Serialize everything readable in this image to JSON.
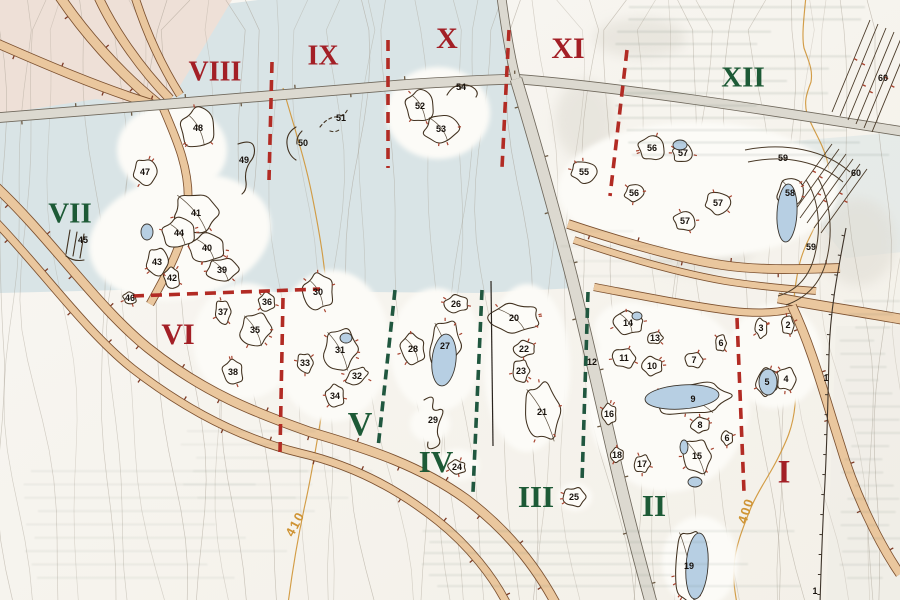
{
  "map": {
    "colors": {
      "paper": "#f8f6f1",
      "valley": "#d9e4e6",
      "pink": "#eee0d7",
      "white_area": "#fcfbf7",
      "zone_red": "#a31f26",
      "zone_green": "#1d5a36",
      "boundary_red": "#b22b24",
      "boundary_green": "#20573f",
      "water": "#b7cfe3",
      "water_edge": "#3a342c",
      "road_fill": "#eac79e",
      "road_casing": "#7c5130",
      "gray_road_fill": "#dcd9d0",
      "gray_road_casing": "#6f685c",
      "contour": "#a1988a",
      "contour_index": "#cf9434",
      "ink": "#41311f",
      "tick_red": "#a84430",
      "label_ink": "#17110c"
    },
    "zones": [
      {
        "label": "VIII",
        "x": 215,
        "y": 74,
        "c": "red",
        "s": 28
      },
      {
        "label": "IX",
        "x": 323,
        "y": 58,
        "c": "red",
        "s": 28
      },
      {
        "label": "X",
        "x": 447,
        "y": 41,
        "c": "red",
        "s": 30
      },
      {
        "label": "XI",
        "x": 568,
        "y": 51,
        "c": "red",
        "s": 30
      },
      {
        "label": "XII",
        "x": 743,
        "y": 80,
        "c": "green",
        "s": 29
      },
      {
        "label": "VII",
        "x": 70,
        "y": 216,
        "c": "green",
        "s": 29
      },
      {
        "label": "VI",
        "x": 178,
        "y": 337,
        "c": "red",
        "s": 30
      },
      {
        "label": "V",
        "x": 360,
        "y": 427,
        "c": "green",
        "s": 34
      },
      {
        "label": "IV",
        "x": 436,
        "y": 465,
        "c": "green",
        "s": 31
      },
      {
        "label": "III",
        "x": 536,
        "y": 500,
        "c": "green",
        "s": 31
      },
      {
        "label": "II",
        "x": 654,
        "y": 509,
        "c": "green",
        "s": 31
      },
      {
        "label": "I",
        "x": 784,
        "y": 475,
        "c": "red",
        "s": 33
      }
    ],
    "contour_labels": [
      {
        "text": "410",
        "x": 299,
        "y": 526,
        "rot": -62
      },
      {
        "text": "400",
        "x": 750,
        "y": 512,
        "rot": -72
      }
    ],
    "features": [
      {
        "n": "1",
        "x": 826,
        "y": 378,
        "t": "none"
      },
      {
        "n": "1",
        "x": 815,
        "y": 591,
        "t": "none"
      },
      {
        "n": "2",
        "x": 788,
        "y": 325,
        "rx": 7,
        "ry": 9
      },
      {
        "n": "3",
        "x": 761,
        "y": 328,
        "rx": 6,
        "ry": 10
      },
      {
        "n": "4",
        "x": 786,
        "y": 379,
        "rx": 10,
        "ry": 12
      },
      {
        "n": "5",
        "x": 767,
        "y": 382,
        "rx": 11,
        "ry": 14
      },
      {
        "n": "6",
        "x": 721,
        "y": 343,
        "rx": 6,
        "ry": 8
      },
      {
        "n": "6",
        "x": 727,
        "y": 438,
        "rx": 6,
        "ry": 7
      },
      {
        "n": "7",
        "x": 694,
        "y": 360,
        "rx": 9,
        "ry": 8
      },
      {
        "n": "8",
        "x": 700,
        "y": 425,
        "rx": 9,
        "ry": 8
      },
      {
        "n": "9",
        "x": 693,
        "y": 399,
        "rx": 40,
        "ry": 15,
        "rot": -5
      },
      {
        "n": "10",
        "x": 652,
        "y": 366,
        "rx": 11,
        "ry": 9
      },
      {
        "n": "11",
        "x": 624,
        "y": 358,
        "rx": 12,
        "ry": 10
      },
      {
        "n": "12",
        "x": 592,
        "y": 362,
        "t": "none"
      },
      {
        "n": "13",
        "x": 655,
        "y": 338,
        "rx": 8,
        "ry": 6
      },
      {
        "n": "14",
        "x": 628,
        "y": 323,
        "rx": 16,
        "ry": 11,
        "rot": 10
      },
      {
        "n": "15",
        "x": 697,
        "y": 456,
        "rx": 15,
        "ry": 17
      },
      {
        "n": "16",
        "x": 609,
        "y": 414,
        "rx": 7,
        "ry": 11
      },
      {
        "n": "17",
        "x": 642,
        "y": 464,
        "rx": 8,
        "ry": 9
      },
      {
        "n": "18",
        "x": 617,
        "y": 455,
        "rx": 7,
        "ry": 7
      },
      {
        "n": "19",
        "x": 689,
        "y": 566,
        "rx": 15,
        "ry": 36,
        "rot": 4
      },
      {
        "n": "20",
        "x": 514,
        "y": 318,
        "rx": 25,
        "ry": 15,
        "rot": -5
      },
      {
        "n": "21",
        "x": 542,
        "y": 412,
        "rx": 17,
        "ry": 30,
        "rot": -8
      },
      {
        "n": "22",
        "x": 524,
        "y": 349,
        "rx": 11,
        "ry": 8
      },
      {
        "n": "23",
        "x": 521,
        "y": 371,
        "rx": 9,
        "ry": 11
      },
      {
        "n": "24",
        "x": 457,
        "y": 467,
        "rx": 9,
        "ry": 7
      },
      {
        "n": "25",
        "x": 574,
        "y": 497,
        "rx": 11,
        "ry": 10
      },
      {
        "n": "26",
        "x": 456,
        "y": 304,
        "rx": 12,
        "ry": 9
      },
      {
        "n": "27",
        "x": 445,
        "y": 346,
        "rx": 16,
        "ry": 25,
        "rot": 5
      },
      {
        "n": "28",
        "x": 413,
        "y": 349,
        "rx": 13,
        "ry": 15
      },
      {
        "n": "29",
        "x": 433,
        "y": 420,
        "t": "line",
        "d": "M424,400 q11,-7 9,3 q-2,9 5,7 q8,-3 3,8 q-6,13 -2,20 q3,7 -5,10 q-8,3 -6,-6"
      },
      {
        "n": "30",
        "x": 318,
        "y": 292,
        "rx": 15,
        "ry": 19
      },
      {
        "n": "31",
        "x": 340,
        "y": 350,
        "rx": 17,
        "ry": 21
      },
      {
        "n": "32",
        "x": 357,
        "y": 376,
        "rx": 13,
        "ry": 7,
        "rot": -35
      },
      {
        "n": "33",
        "x": 305,
        "y": 363,
        "rx": 8,
        "ry": 10
      },
      {
        "n": "34",
        "x": 335,
        "y": 396,
        "rx": 9,
        "ry": 12
      },
      {
        "n": "35",
        "x": 255,
        "y": 330,
        "rx": 15,
        "ry": 17
      },
      {
        "n": "36",
        "x": 267,
        "y": 302,
        "rx": 9,
        "ry": 9
      },
      {
        "n": "37",
        "x": 223,
        "y": 312,
        "rx": 8,
        "ry": 12
      },
      {
        "n": "38",
        "x": 233,
        "y": 372,
        "rx": 10,
        "ry": 13
      },
      {
        "n": "39",
        "x": 222,
        "y": 270,
        "rx": 15,
        "ry": 12
      },
      {
        "n": "40",
        "x": 207,
        "y": 248,
        "rx": 19,
        "ry": 14
      },
      {
        "n": "41",
        "x": 196,
        "y": 213,
        "rx": 23,
        "ry": 19
      },
      {
        "n": "42",
        "x": 172,
        "y": 278,
        "rx": 8,
        "ry": 11
      },
      {
        "n": "43",
        "x": 157,
        "y": 262,
        "rx": 10,
        "ry": 15
      },
      {
        "n": "44",
        "x": 179,
        "y": 233,
        "rx": 17,
        "ry": 15
      },
      {
        "n": "45",
        "x": 83,
        "y": 240,
        "t": "line",
        "d": "M70,230 l-4,24 M77,232 l-4,24 M84,234 l-4,24 M66,256 q8,6 18,4"
      },
      {
        "n": "46",
        "x": 130,
        "y": 298,
        "rx": 7,
        "ry": 6
      },
      {
        "n": "47",
        "x": 145,
        "y": 172,
        "rx": 11,
        "ry": 14
      },
      {
        "n": "48",
        "x": 198,
        "y": 128,
        "rx": 17,
        "ry": 21
      },
      {
        "n": "49",
        "x": 244,
        "y": 160,
        "t": "line",
        "d": "M238,144 q14,-5 16,3 q2,8 -4,15 q-6,9 -4,20 q1,8 -4,12"
      },
      {
        "n": "50",
        "x": 303,
        "y": 143,
        "t": "line",
        "d": "M296,127 q-10,6 -9,17 q1,11 9,16 M302,131 q-6,6 -5,13"
      },
      {
        "n": "51",
        "x": 341,
        "y": 118,
        "t": "line",
        "dash": true,
        "d": "M320,127 q7,-9 15,-10 q11,-1 13,-9 M330,131 q6,2 10,-2"
      },
      {
        "n": "52",
        "x": 420,
        "y": 106,
        "rx": 14,
        "ry": 17
      },
      {
        "n": "53",
        "x": 441,
        "y": 129,
        "rx": 17,
        "ry": 14
      },
      {
        "n": "54",
        "x": 461,
        "y": 87,
        "t": "line",
        "d": "M447,95 q5,-9 13,-10 q10,-1 15,4 q4,4 1,8"
      },
      {
        "n": "55",
        "x": 584,
        "y": 172,
        "rx": 13,
        "ry": 11
      },
      {
        "n": "56",
        "x": 652,
        "y": 148,
        "rx": 13,
        "ry": 13
      },
      {
        "n": "56",
        "x": 634,
        "y": 193,
        "rx": 9,
        "ry": 9
      },
      {
        "n": "57",
        "x": 683,
        "y": 153,
        "rx": 11,
        "ry": 9
      },
      {
        "n": "57",
        "x": 718,
        "y": 203,
        "rx": 13,
        "ry": 11
      },
      {
        "n": "57",
        "x": 685,
        "y": 221,
        "rx": 11,
        "ry": 10
      },
      {
        "n": "58",
        "x": 790,
        "y": 193,
        "rx": 12,
        "ry": 16
      },
      {
        "n": "59",
        "x": 783,
        "y": 158,
        "t": "none"
      },
      {
        "n": "59",
        "x": 811,
        "y": 247,
        "t": "none"
      },
      {
        "n": "60",
        "x": 883,
        "y": 78,
        "t": "none"
      },
      {
        "n": "60",
        "x": 856,
        "y": 173,
        "t": "none"
      }
    ],
    "ponds": [
      {
        "x": 147,
        "y": 232,
        "rx": 6,
        "ry": 8,
        "rot": 0
      },
      {
        "x": 346,
        "y": 338,
        "rx": 6,
        "ry": 5,
        "rot": 0
      },
      {
        "x": 444,
        "y": 360,
        "rx": 12,
        "ry": 26,
        "rot": 6
      },
      {
        "x": 682,
        "y": 397,
        "rx": 37,
        "ry": 12,
        "rot": -4
      },
      {
        "x": 768,
        "y": 382,
        "rx": 9,
        "ry": 13,
        "rot": 0
      },
      {
        "x": 684,
        "y": 447,
        "rx": 4,
        "ry": 7,
        "rot": 0
      },
      {
        "x": 695,
        "y": 482,
        "rx": 7,
        "ry": 5,
        "rot": 0
      },
      {
        "x": 697,
        "y": 566,
        "rx": 11,
        "ry": 33,
        "rot": 4
      },
      {
        "x": 680,
        "y": 145,
        "rx": 7,
        "ry": 5,
        "rot": 0
      },
      {
        "x": 787,
        "y": 213,
        "rx": 10,
        "ry": 29,
        "rot": 3
      },
      {
        "x": 637,
        "y": 316,
        "rx": 5,
        "ry": 4,
        "rot": 0
      }
    ],
    "terrain": {
      "valley": "M0,46 L92,27 L185,9 L258,0 L500,0 L506,20 L516,79 L553,208 L576,288 L480,293 L360,292 L240,292 L120,290 L0,293 Z",
      "pink": "M0,0 L232,0 L166,109 L96,99 L0,114 Z",
      "blue2": "M793,141 L902,132 L902,252 L846,258 L806,206 Z",
      "graywash": "M836,326 L902,326 L902,606 L826,606 Z"
    },
    "white_areas": [
      [
        172,
        150,
        55,
        46,
        0
      ],
      [
        438,
        113,
        52,
        46,
        0
      ],
      [
        180,
        237,
        92,
        62,
        -12
      ],
      [
        245,
        341,
        52,
        58,
        0
      ],
      [
        332,
        346,
        58,
        76,
        0
      ],
      [
        436,
        350,
        46,
        62,
        0
      ],
      [
        527,
        368,
        43,
        84,
        0
      ],
      [
        668,
        398,
        82,
        94,
        0
      ],
      [
        775,
        356,
        47,
        52,
        0
      ],
      [
        700,
        562,
        38,
        46,
        0
      ],
      [
        698,
        190,
        140,
        68,
        0
      ],
      [
        458,
        465,
        21,
        16,
        0
      ],
      [
        575,
        497,
        17,
        14,
        0
      ],
      [
        430,
        424,
        20,
        18,
        0
      ],
      [
        630,
        330,
        36,
        28,
        0
      ]
    ],
    "roads": {
      "tan": [
        {
          "d": "M58,-6 C82,30 118,72 158,104",
          "w": 9
        },
        {
          "d": "M97,-6 C112,28 140,68 170,99",
          "w": 8
        },
        {
          "d": "M134,-6 C144,26 158,60 180,95",
          "w": 7
        },
        {
          "d": "M-6,42 C42,63 100,88 152,104",
          "w": 8
        },
        {
          "d": "M161,103 C176,138 190,168 188,204 C186,240 168,272 150,304",
          "w": 7
        },
        {
          "d": "M-6,185 C50,237 96,306 148,348 C204,393 256,413 310,432 C372,450 420,466 466,499 C506,529 536,566 557,606",
          "w": 8.5
        },
        {
          "d": "M-6,220 C40,267 86,332 133,369 C186,410 242,439 300,453 C352,465 398,489 438,521 C468,545 494,577 508,606",
          "w": 7
        },
        {
          "d": "M568,224 C622,242 682,259 722,265 C762,271 802,269 840,268",
          "w": 8
        },
        {
          "d": "M574,240 C624,257 680,273 725,281 C762,287 792,289 816,291",
          "w": 6
        },
        {
          "d": "M594,287 C642,296 692,306 732,311 C758,314 776,313 792,309",
          "w": 6.5
        },
        {
          "d": "M778,298 C820,306 862,312 906,320",
          "w": 9
        },
        {
          "d": "M792,306 C812,348 824,394 840,444 C854,492 878,542 900,574",
          "w": 8
        }
      ],
      "gray": [
        {
          "d": "M-6,118 C120,109 300,92 400,85 C455,81 492,80 516,79",
          "w": 9
        },
        {
          "d": "M516,79 C620,87 760,109 906,132",
          "w": 8.5
        },
        {
          "d": "M501,-6 C505,24 510,56 516,79",
          "w": 8
        },
        {
          "d": "M516,79 C529,122 549,192 568,263 C581,312 599,392 614,457 C629,522 641,566 652,606",
          "w": 11
        }
      ]
    },
    "boundaries": {
      "red": [
        "M272,62 L269,180",
        "M388,40 L388,168",
        "M509,30 L502,168",
        "M627,50 L610,196",
        "M133,296 L320,289",
        "M283,298 L280,452",
        "M737,318 L744,492"
      ],
      "green": [
        "M395,290 L378,448",
        "M482,290 L473,492",
        "M588,292 L582,482"
      ],
      "stream": "M491,281 L493,446"
    },
    "earthworks": {
      "hatch_groups": [
        [
          [
            832,
            112,
            870,
            20
          ],
          [
            840,
            116,
            878,
            24
          ],
          [
            848,
            120,
            886,
            28
          ],
          [
            856,
            124,
            894,
            32
          ],
          [
            864,
            128,
            902,
            36
          ],
          [
            872,
            132,
            910,
            40
          ]
        ],
        [
          [
            786,
            208,
            832,
            144
          ],
          [
            793,
            213,
            839,
            149
          ],
          [
            800,
            218,
            846,
            154
          ],
          [
            807,
            223,
            853,
            159
          ],
          [
            814,
            228,
            860,
            164
          ],
          [
            821,
            233,
            867,
            169
          ]
        ]
      ],
      "fence": "M846,228 C838,270 830,310 829,355 C828,400 827,450 824,500 C822,540 821,570 820,604",
      "banks": [
        "M745,150 C785,142 825,150 850,172",
        "M748,162 C786,154 820,162 843,182",
        "M806,180 C818,198 822,226 815,254 C810,276 798,290 778,296",
        "M818,178 C830,200 834,232 826,262 C820,284 806,298 786,305"
      ]
    },
    "index_contours": [
      "M283,88 C295,130 305,160 312,195 C320,235 327,275 328,318 C329,355 327,382 322,412 C317,442 312,472 306,500 C300,527 294,558 288,604",
      "M806,-4 C803,25 802,38 804,48 C809,62 813,70 811,82 C806,95 804,102 807,114 C814,132 822,142 827,160 C831,178 830,188 824,205 C816,228 806,240 800,262 C794,286 792,310 793,338 C794,365 797,382 795,405 C793,428 786,442 778,458 C768,478 757,492 750,510 C742,530 735,548 734,566 C733,582 735,592 737,604"
    ]
  }
}
